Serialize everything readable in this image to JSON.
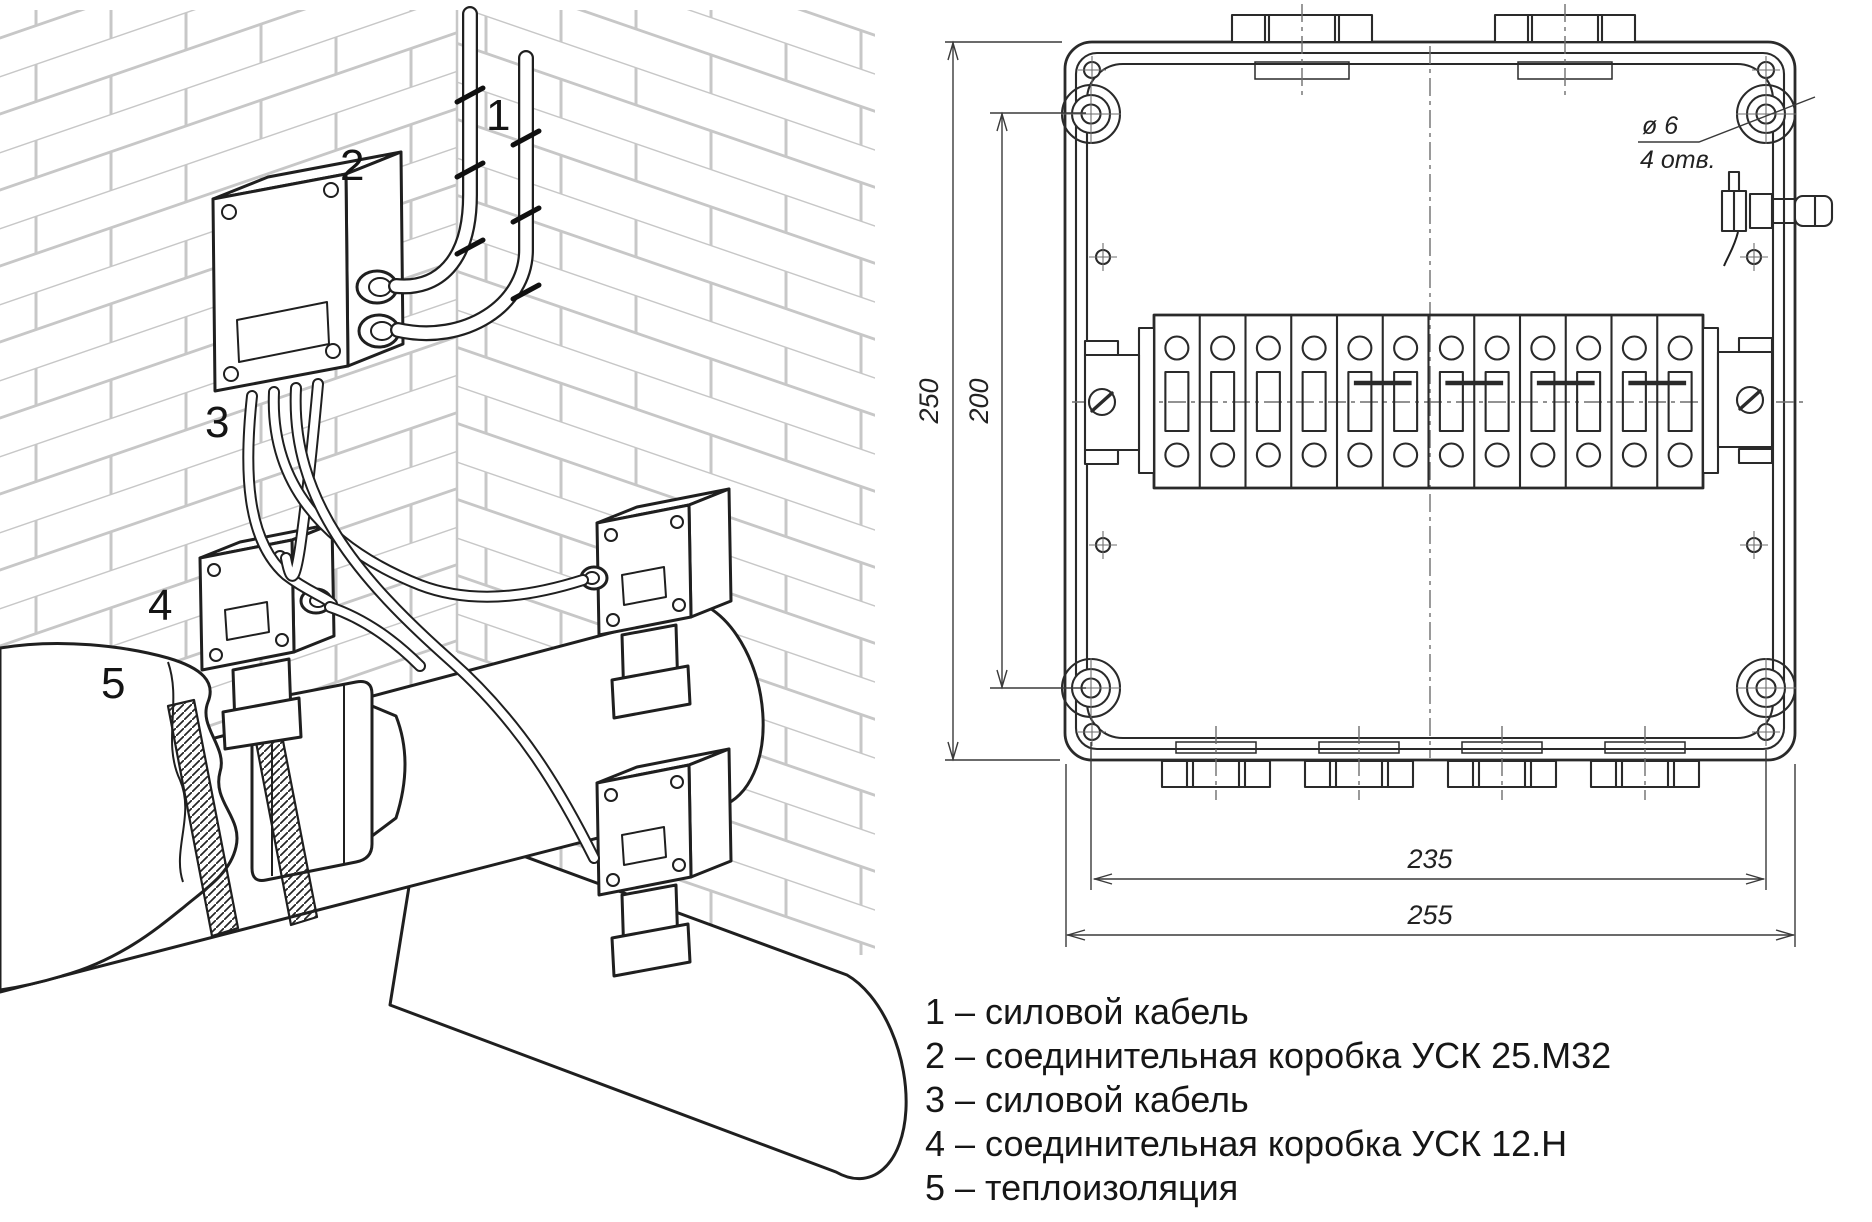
{
  "figure": {
    "callouts": {
      "c1": "1",
      "c2": "2",
      "c3": "3",
      "c4": "4",
      "c5": "5"
    }
  },
  "legend": {
    "items": [
      "1 – силовой кабель",
      "2 – соединительная коробка УСК 25.М32",
      "3 – силовой кабель",
      "4 – соединительная коробка УСК 12.Н",
      "5 – теплоизоляция"
    ]
  },
  "drawing": {
    "dimensions": {
      "height_outer": "250",
      "height_holes": "200",
      "width_holes": "235",
      "width_outer": "255"
    },
    "hole_note": {
      "diameter": "ø 6",
      "count": "4 отв."
    },
    "terminal_strip": {
      "count": 12,
      "jumpered_pairs": [
        [
          5,
          6
        ],
        [
          7,
          8
        ],
        [
          9,
          10
        ],
        [
          11,
          12
        ]
      ]
    }
  },
  "colors": {
    "line": "#1f1f1f",
    "brick": "#c7c7c7",
    "dimension": "#3a3a3a"
  }
}
